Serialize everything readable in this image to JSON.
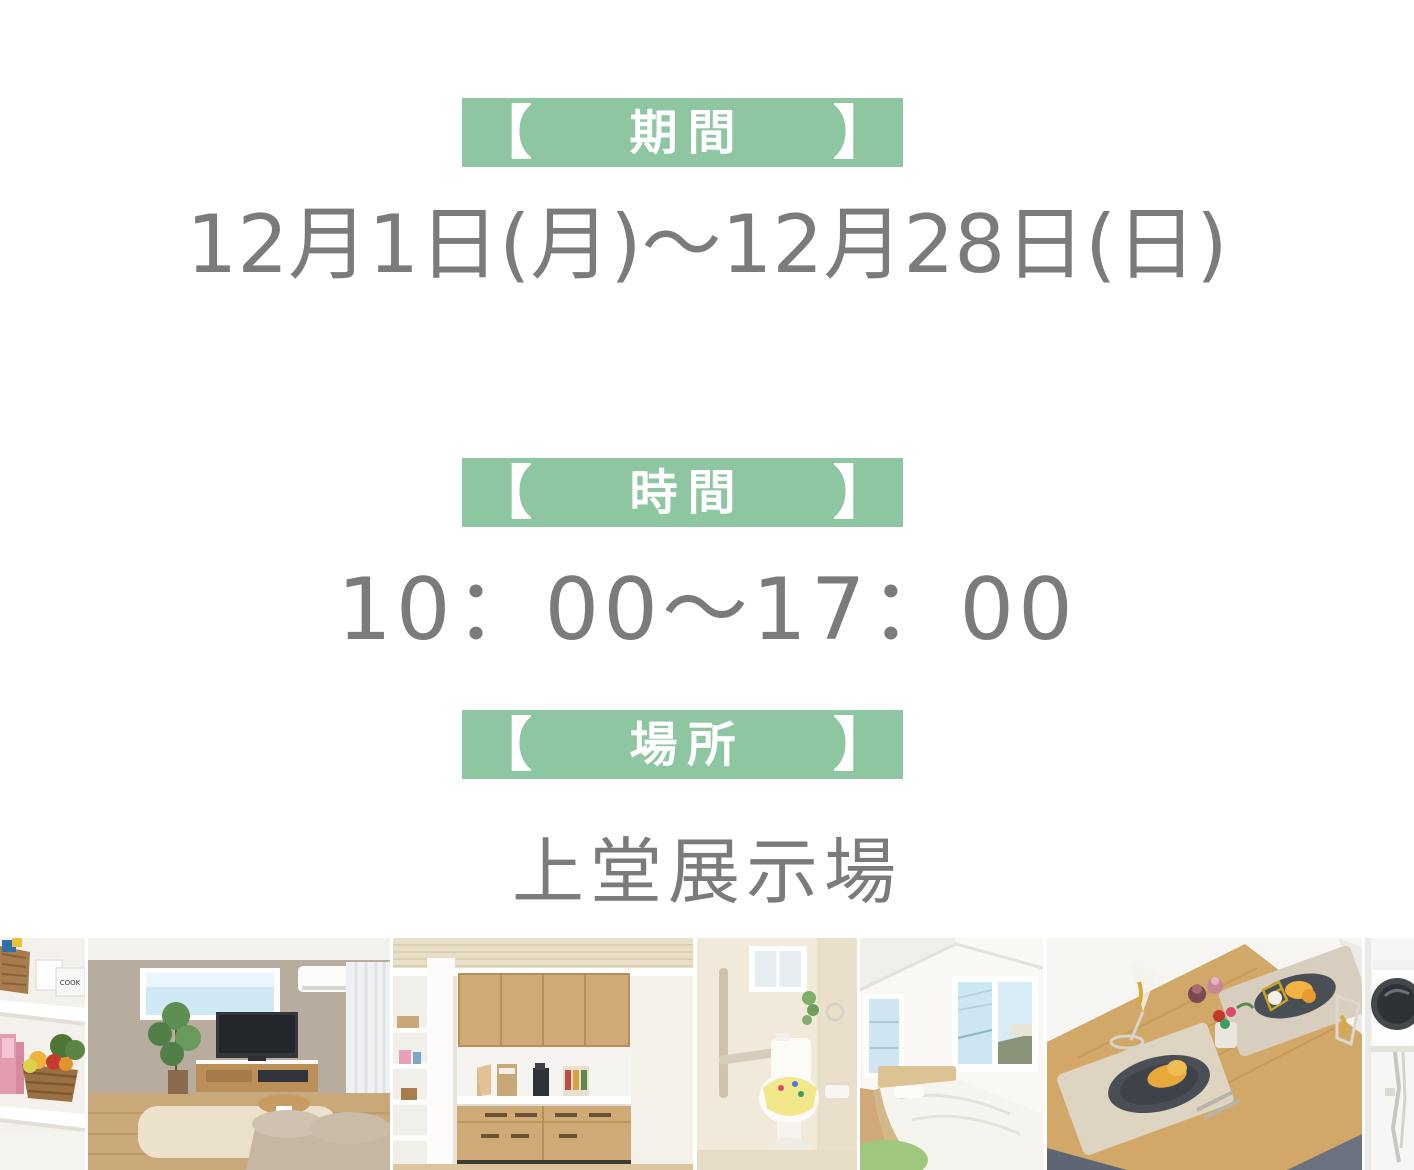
{
  "meta": {
    "background": "#ffffff",
    "accent_green": "#8ec6a2",
    "text_gray": "#7b7b7b",
    "label_white": "#ffffff"
  },
  "sections": {
    "period": {
      "bracket_left": "【",
      "label": "期間",
      "bracket_right": "】",
      "value": "12月1日(月)〜12月28日(日)"
    },
    "time": {
      "bracket_left": "【",
      "label": "時間",
      "bracket_right": "】",
      "value": "10：00〜17：00"
    },
    "place": {
      "bracket_left": "【",
      "label": "場所",
      "bracket_right": "】",
      "value": "上堂展示場"
    }
  },
  "photo_strip": {
    "photos": [
      {
        "name": "pantry-shelf-photo",
        "box_label": "COOK"
      },
      {
        "name": "living-room-photo"
      },
      {
        "name": "kitchen-photo"
      },
      {
        "name": "toilet-photo"
      },
      {
        "name": "bedroom-photo"
      },
      {
        "name": "dining-table-photo"
      },
      {
        "name": "laundry-dryer-photo"
      }
    ]
  }
}
